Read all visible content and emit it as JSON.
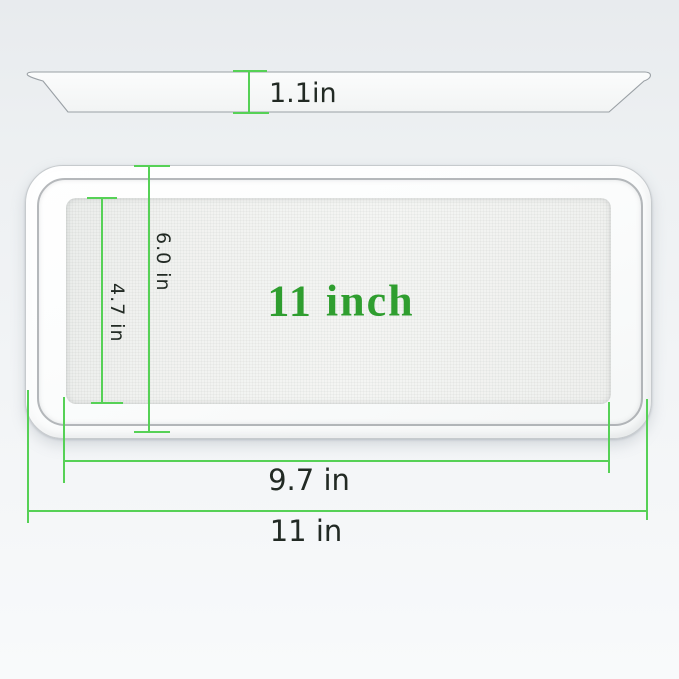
{
  "image": {
    "type": "product-dimension-diagram",
    "subject": "rectangular white tray shown in side profile and top view with measurements"
  },
  "labels": {
    "side_depth": "1.1in",
    "outer_height": "6.0 in",
    "inner_height": "4.7 in",
    "inner_width": "9.7 in",
    "outer_width": "11 in",
    "center": "11 inch"
  },
  "colors": {
    "dimension_line": "#56d156",
    "dimension_text": "#222a24",
    "center_text": "#2f9e2f",
    "background_top": "#e8ebee",
    "background_bottom": "#f8fafb"
  }
}
